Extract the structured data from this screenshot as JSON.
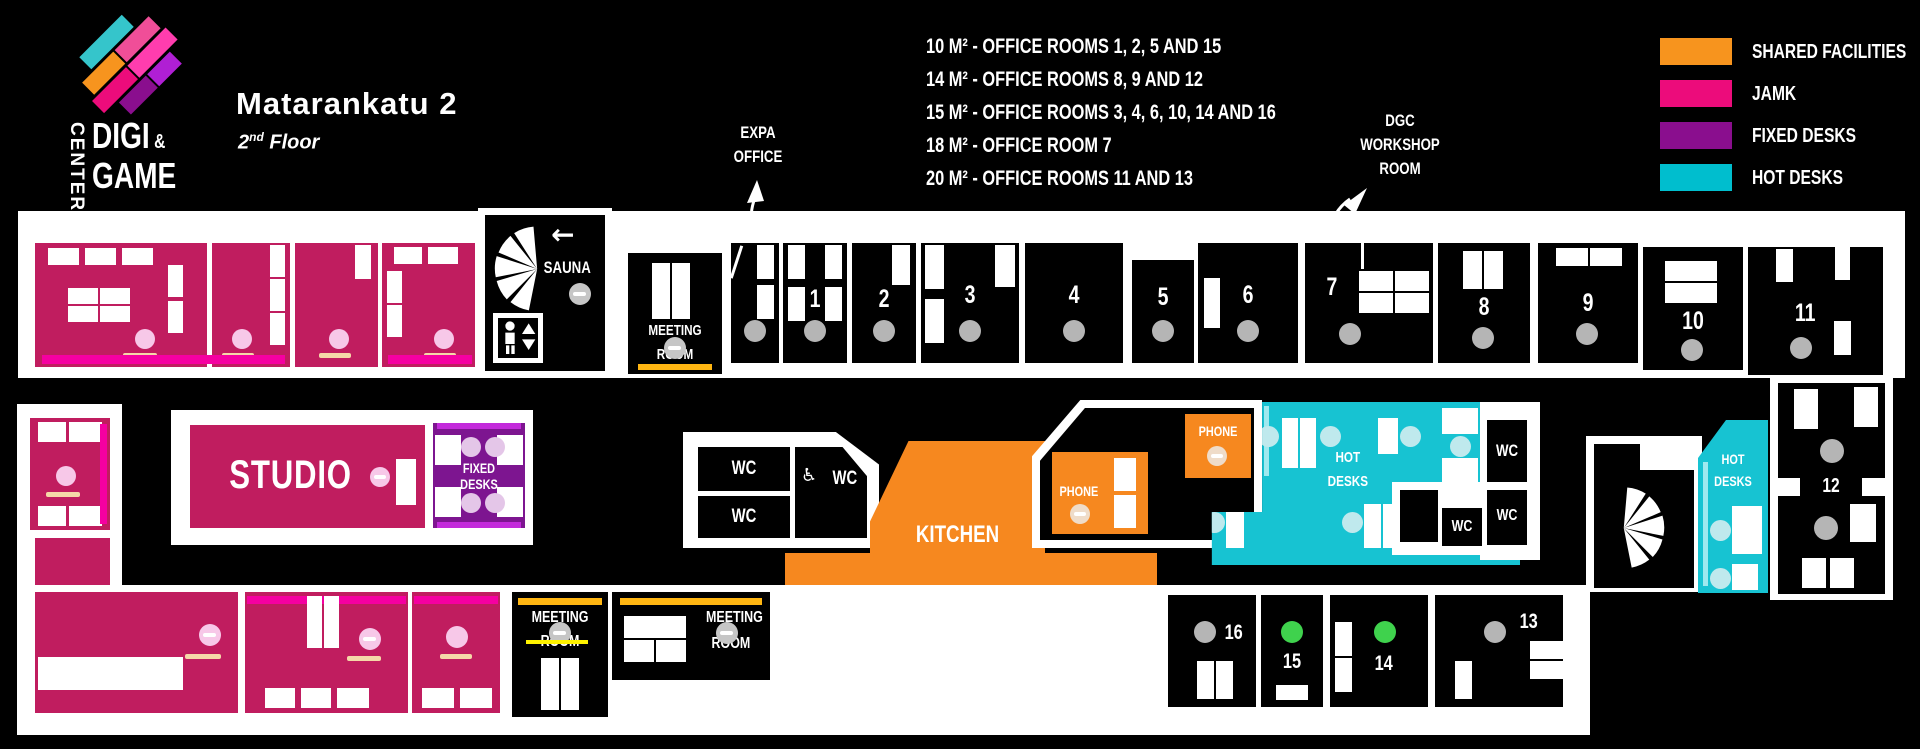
{
  "header": {
    "logo_center": "CENTER",
    "logo_digi": "DIGI",
    "logo_amp": "&",
    "logo_game": "GAME",
    "title": "Matarankatu 2",
    "subtitle_num": "2",
    "subtitle_sup": "nd",
    "subtitle_rest": " Floor"
  },
  "info": {
    "lines": [
      "10 M² - OFFICE ROOMS 1, 2, 5 AND 15",
      "14 M² - OFFICE ROOMS 8, 9 AND 12",
      "15 M² - OFFICE ROOMS 3, 4, 6, 10, 14 AND 16",
      "18 M² - OFFICE ROOM 7",
      "20 M² - OFFICE ROOMS 11 AND 13"
    ]
  },
  "callouts": {
    "expa": [
      "EXPA",
      "OFFICE"
    ],
    "dgc": [
      "DGC",
      "WORKSHOP",
      "ROOM"
    ]
  },
  "legend": {
    "items": [
      {
        "label": "SHARED FACILITIES",
        "color": "#F7941E"
      },
      {
        "label": "JAMK",
        "color": "#EC0C7B"
      },
      {
        "label": "FIXED DESKS",
        "color": "#8A0E8E"
      },
      {
        "label": "HOT DESKS",
        "color": "#00BECE"
      }
    ]
  },
  "labels": {
    "sauna": "SAUNA",
    "wc": "WC",
    "kitchen": "KITCHEN",
    "stage": "STAGE",
    "phone": "PHONE",
    "studio": "STUDIO",
    "meeting": [
      "MEETING",
      "ROOM"
    ],
    "fixed": [
      "FIXED",
      "DESKS"
    ],
    "hot": [
      "HOT",
      "DESKS"
    ]
  },
  "rooms": {
    "numbers": [
      "1",
      "2",
      "3",
      "4",
      "5",
      "6",
      "7",
      "8",
      "9",
      "10",
      "11",
      "12",
      "13",
      "14",
      "15",
      "16"
    ]
  },
  "status_colors": {
    "free": "#3FD24D",
    "neutral": "#B5B5B5"
  }
}
